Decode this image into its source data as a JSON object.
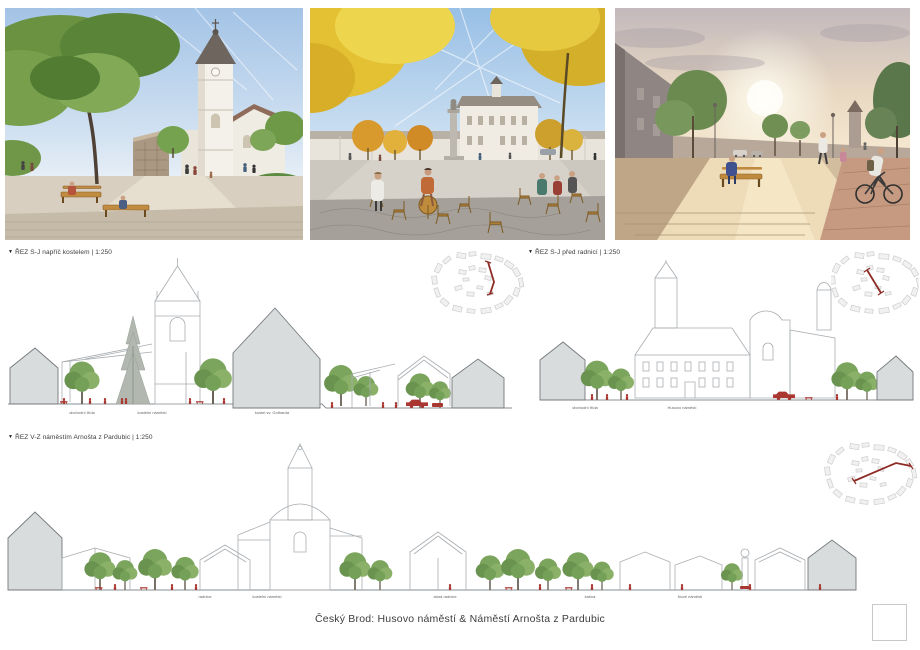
{
  "board": {
    "project_title": "Český Brod: Husovo náměstí & Náměstí Arnošta z Pardubic"
  },
  "sections": [
    {
      "marker": "▼",
      "label": "ŘEZ S-J napříč kostelem | 1:250",
      "ground_labels": [
        "obchodní třída",
        "kostelní náměstí",
        "kostel sv. Gotharda"
      ]
    },
    {
      "marker": "▼",
      "label": "ŘEZ S-J před radnicí | 1:250",
      "ground_labels": [
        "obchodní třída",
        "Husovo náměstí"
      ]
    },
    {
      "marker": "▼",
      "label": "ŘEZ V-Z náměstím Arnošta z Pardubic | 1:250",
      "ground_labels": [
        "radnice",
        "kostelní náměstí",
        "stará radnice",
        "kašna",
        "Nové náměstí"
      ]
    }
  ],
  "colors": {
    "accent_red": "#a93630",
    "section_cut_fill": "#d9dcdd",
    "section_outline": "#a7acb0",
    "tree_green": "#7ba45c",
    "label_gray": "#666666"
  }
}
